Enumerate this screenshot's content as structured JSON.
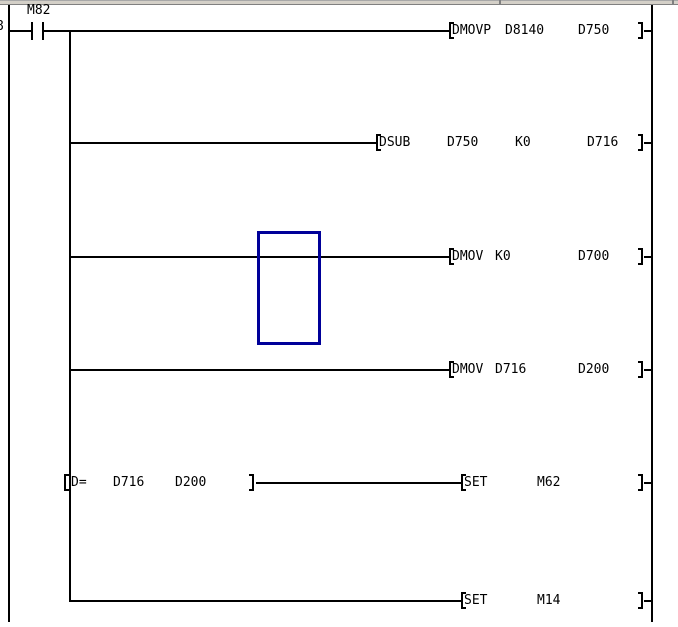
{
  "window": {
    "top_edge_fill": "#d4d0c8",
    "top_edge_border": "#808080"
  },
  "ladder": {
    "step_number": "8",
    "contact_label": "M82",
    "cursor_color": "#000099",
    "rungs": [
      {
        "mnemonic": "DMOVP",
        "op1": "D8140",
        "op2": "D750"
      },
      {
        "mnemonic": "DSUB",
        "op1": "D750",
        "op2": "K0",
        "op3": "D716"
      },
      {
        "mnemonic": "DMOV",
        "op1": "K0",
        "op2": "D700"
      },
      {
        "mnemonic": "DMOV",
        "op1": "D716",
        "op2": "D200"
      },
      {
        "compare_mnemonic": "D=",
        "compare_op1": "D716",
        "compare_op2": "D200",
        "mnemonic": "SET",
        "op1": "M62"
      },
      {
        "mnemonic": "SET",
        "op1": "M14"
      }
    ]
  }
}
